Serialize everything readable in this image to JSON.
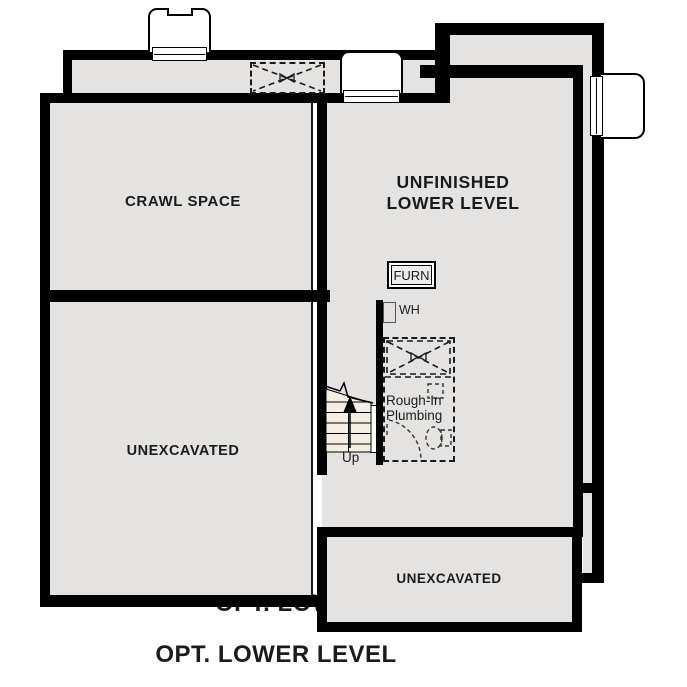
{
  "title": {
    "text": "OPT. LOWER LEVEL",
    "behind_text": "OPT. LOWER LEVEL"
  },
  "rooms": {
    "crawl_space": "CRAWL SPACE",
    "unfinished_line1": "UNFINISHED",
    "unfinished_line2": "LOWER LEVEL",
    "unexcavated_left": "UNEXCAVATED",
    "unexcavated_bottom": "UNEXCAVATED"
  },
  "equipment": {
    "furnace": "FURN",
    "water_heater": "WH"
  },
  "annotations": {
    "plumbing_line1": "Rough-In",
    "plumbing_line2": "Plumbing",
    "stairs_up": "Up"
  },
  "colors": {
    "wall": "#000000",
    "room_fill": "#e5e3e1",
    "stair_fill": "#f4efe2",
    "paper": "#ffffff"
  }
}
